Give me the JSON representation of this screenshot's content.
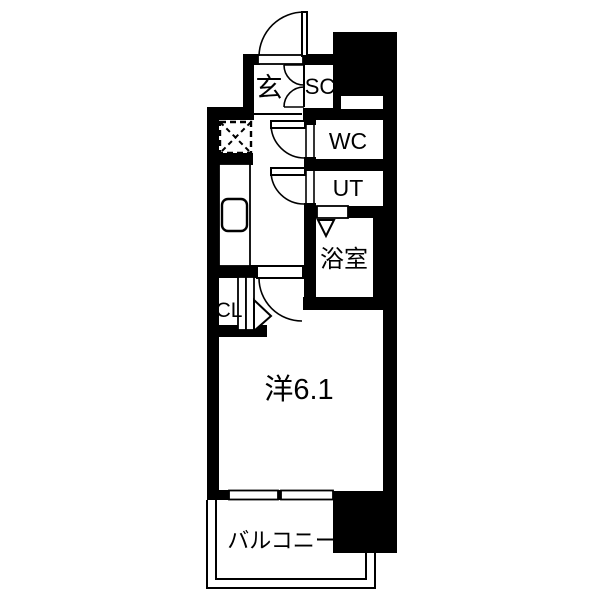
{
  "colors": {
    "wall": "#000000",
    "background": "#ffffff",
    "text": "#000000"
  },
  "rooms": {
    "genkan": {
      "label": "玄"
    },
    "shoe_closet": {
      "label": "SC"
    },
    "toilet": {
      "label": "WC"
    },
    "utility": {
      "label": "UT"
    },
    "bathroom": {
      "label": "浴室"
    },
    "closet": {
      "label": "CL"
    },
    "western_room": {
      "label": "洋6.1"
    },
    "balcony": {
      "label": "バルコニー"
    }
  }
}
